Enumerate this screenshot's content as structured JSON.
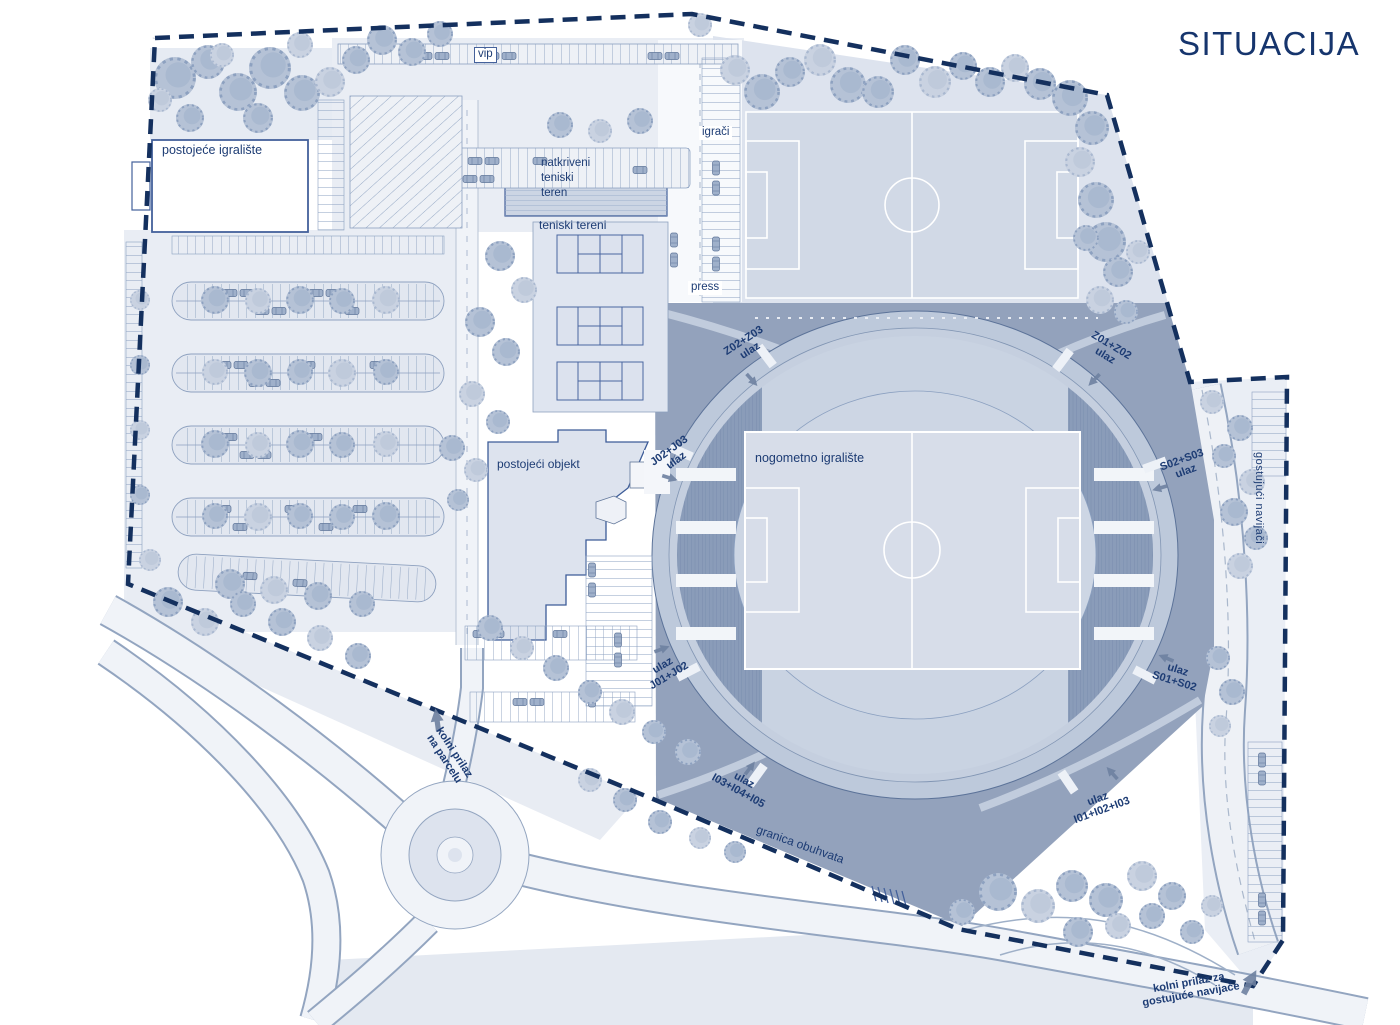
{
  "title": "SITUACIJA",
  "areas": {
    "postojece_igraliste": "postojeće igralište",
    "vip": "vip",
    "igraci": "igrači",
    "natkriveni_teniski_teren": "natkriveni\nteniski\nteren",
    "teniski_tereni": "teniski tereni",
    "press": "press",
    "nogometno_igraliste": "nogometno igralište",
    "postojeci_objekt": "postojeći objekt",
    "gostujuci_navijaci": "gostujući navijači"
  },
  "boundary": {
    "label": "granica obuhvata"
  },
  "access_labels": {
    "parcel": "kolni prilaz\nna parcelu",
    "away_fans": "kolni prilaz za\ngostujuće navijače"
  },
  "entrances": [
    {
      "line1": "Z02+Z03",
      "line2": "ulaz"
    },
    {
      "line1": "Z01+Z02",
      "line2": "ulaz"
    },
    {
      "line1": "J02+J03",
      "line2": "ulaz"
    },
    {
      "line1": "S02+S03",
      "line2": "ulaz"
    },
    {
      "line1": "ulaz",
      "line2": "J01+J02"
    },
    {
      "line1": "ulaz",
      "line2": "S01+S02"
    },
    {
      "line1": "ulaz",
      "line2": "I03+I04+I05"
    },
    {
      "line1": "ulaz",
      "line2": "I01+I02+I03"
    }
  ],
  "colors": {
    "navy_text": "#1d3c74",
    "boundary_dash": "#14305e",
    "plaza": "#93a2bc",
    "stand": "#8a9cb9",
    "pitch": "#d3dae7",
    "tree": "#b5c2d6",
    "road": "#f0f3f8"
  }
}
